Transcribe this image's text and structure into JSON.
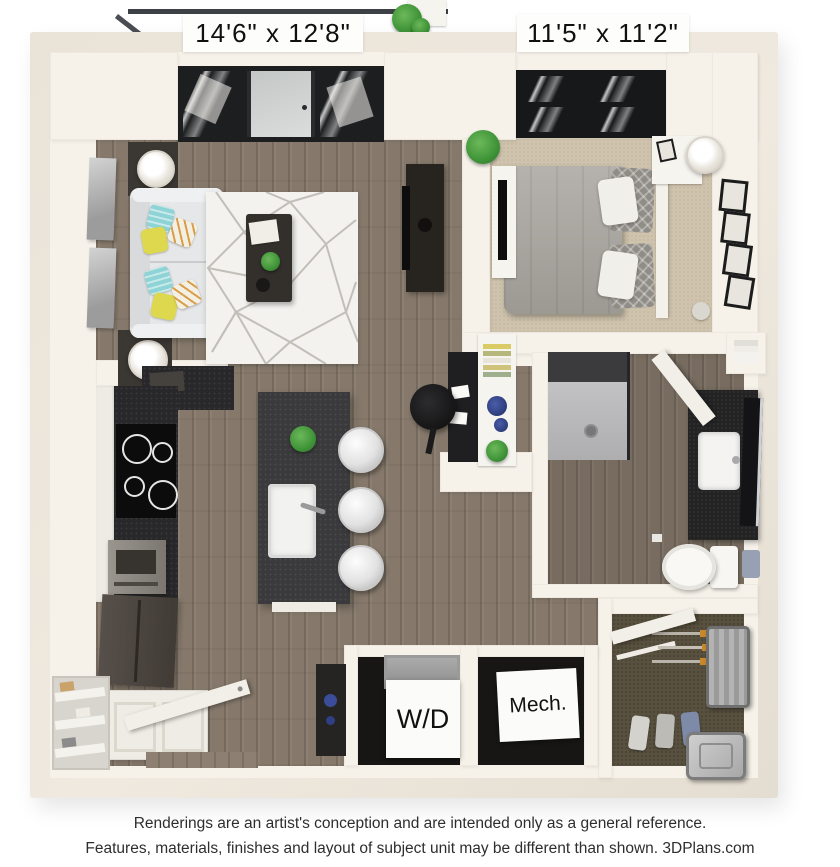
{
  "floorplan": {
    "living_room": {
      "dimensions": "14'6\" x 12'8\""
    },
    "bedroom": {
      "dimensions": "11'5\" x 11'2\""
    },
    "utility": {
      "washer_dryer_label": "W/D",
      "mechanical_label": "Mech."
    }
  },
  "disclaimer": {
    "line1": "Renderings are an artist's conception and are intended only as a general reference.",
    "line2": "Features, materials, finishes and layout of subject unit may be different than shown. 3DPlans.com"
  },
  "palette": {
    "wall": "#f6f2ea",
    "outer_wall": "#e9e3d8",
    "wood": "#86796b",
    "bath_wood": "#776c5f",
    "carpet": "#cfc3ad",
    "closet_carpet": "#59513f",
    "counter_dark": "#28282a",
    "island": "#3a3a3d",
    "sofa": "#e6e7e8",
    "accent_yellow": "#ded84e",
    "accent_teal": "#8ed3d6",
    "plant": "#3f9438",
    "frame_dark": "#1d1e20",
    "text": "#101010"
  }
}
